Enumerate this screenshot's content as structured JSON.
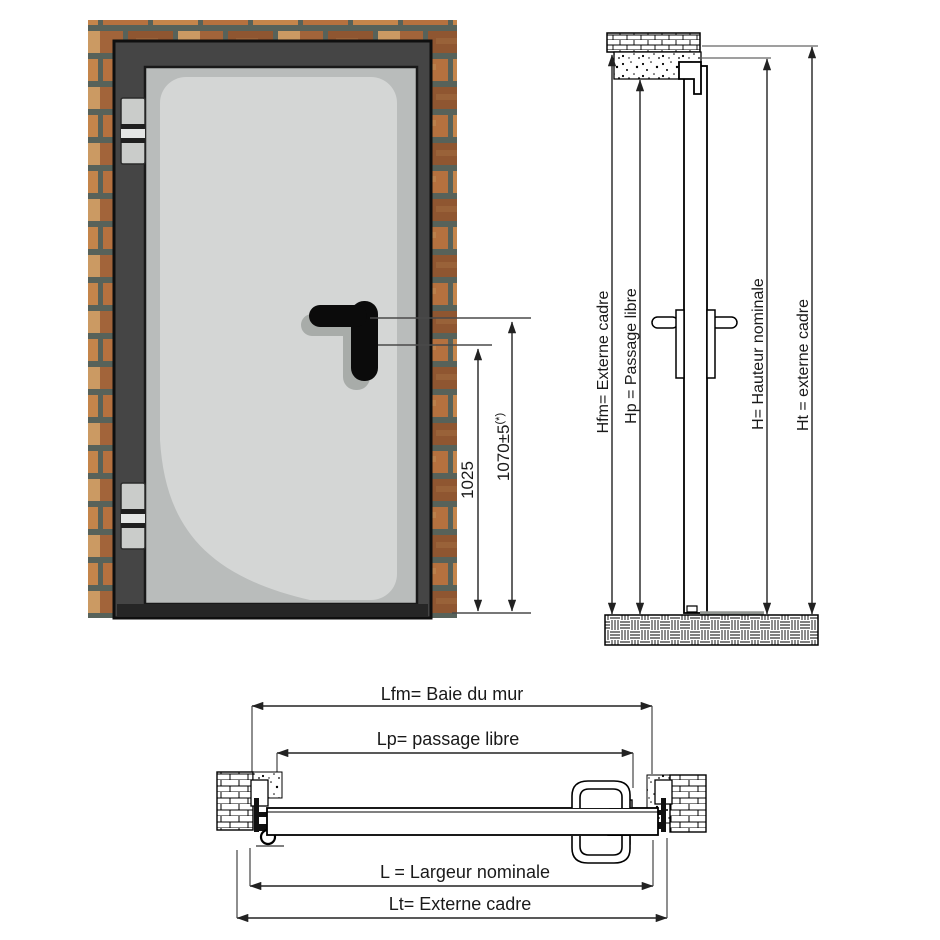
{
  "front_view": {
    "dim_inner": "1025",
    "dim_outer_value": "1070±5",
    "dim_outer_note": "(*)"
  },
  "section_view": {
    "hfm_label": "Hfm= Externe cadre",
    "hp_label": "Hp = Passage libre",
    "h_label": "H= Hauteur nominale",
    "ht_label": "Ht = externe cadre"
  },
  "plan_view": {
    "lfm_label": "Lfm= Baie du mur",
    "lp_label": "Lp= passage libre",
    "l_label": "L = Largeur nominale",
    "lt_label": "Lt= Externe cadre"
  },
  "colors": {
    "frame": "#454545",
    "door": "#b9bcbb",
    "panel": "#d4d6d5",
    "handle": "#0b0b0b",
    "handle_shadow": "#a8aca9",
    "mortar": "#57625a",
    "hinge": "#caccca",
    "drawing_line": "#222222",
    "dim_line": "#4a4a4a"
  }
}
